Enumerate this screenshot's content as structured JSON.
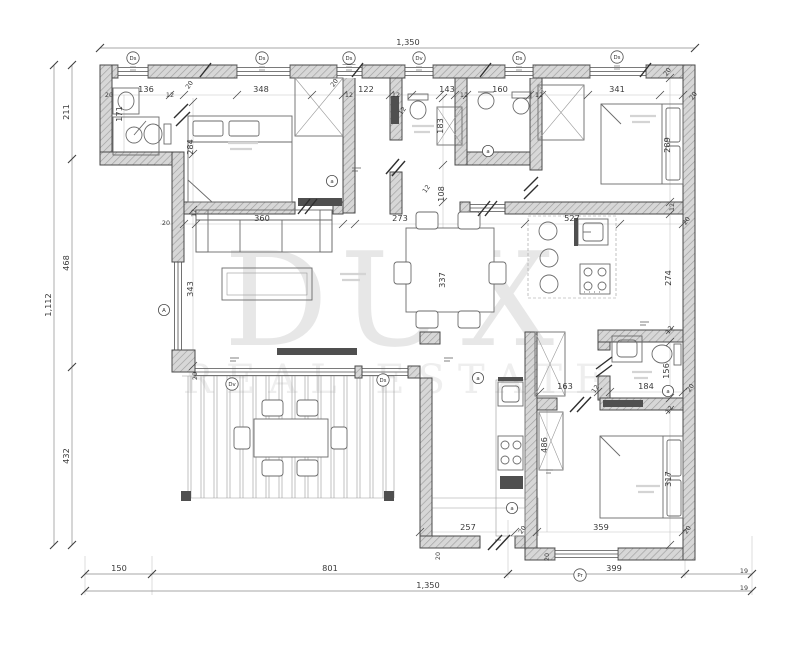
{
  "watermark": {
    "line1": "DUX",
    "line2": "REAL ESTATE"
  },
  "colors": {
    "background": "#ffffff",
    "line": "#4a4a4a",
    "wall_fill": "#d7d7d7",
    "hatch": "#9e9e9e",
    "dim_text": "#3a3a3a",
    "watermark": "#e7e7e7",
    "watermark_light": "#eeeeee",
    "furniture": "#6b6b6b"
  },
  "dimension_labels": [
    {
      "v": "1,350",
      "x": 408,
      "y": 45
    },
    {
      "v": "211",
      "x": 69,
      "y": 112,
      "r": -90
    },
    {
      "v": "468",
      "x": 69,
      "y": 263,
      "r": -90
    },
    {
      "v": "432",
      "x": 69,
      "y": 456,
      "r": -90
    },
    {
      "v": "1,112",
      "x": 51,
      "y": 305,
      "r": -90
    },
    {
      "v": "150",
      "x": 119,
      "y": 571
    },
    {
      "v": "801",
      "x": 330,
      "y": 571
    },
    {
      "v": "399",
      "x": 614,
      "y": 571
    },
    {
      "v": "19",
      "x": 744,
      "y": 573,
      "s": 1
    },
    {
      "v": "1,350",
      "x": 428,
      "y": 588
    },
    {
      "v": "19",
      "x": 744,
      "y": 590,
      "s": 1
    },
    {
      "v": "20",
      "x": 109,
      "y": 97,
      "s": 1
    },
    {
      "v": "136",
      "x": 146,
      "y": 92
    },
    {
      "v": "12",
      "x": 170,
      "y": 97,
      "s": 1
    },
    {
      "v": "20",
      "x": 191,
      "y": 86,
      "r": -55,
      "s": 1
    },
    {
      "v": "348",
      "x": 261,
      "y": 92
    },
    {
      "v": "20",
      "x": 336,
      "y": 84,
      "r": -55,
      "s": 1
    },
    {
      "v": "12",
      "x": 349,
      "y": 97,
      "s": 1
    },
    {
      "v": "122",
      "x": 366,
      "y": 92
    },
    {
      "v": "12",
      "x": 396,
      "y": 97,
      "s": 1
    },
    {
      "v": "143",
      "x": 447,
      "y": 92
    },
    {
      "v": "12",
      "x": 464,
      "y": 97,
      "s": 1
    },
    {
      "v": "160",
      "x": 500,
      "y": 92
    },
    {
      "v": "12",
      "x": 539,
      "y": 97,
      "s": 1
    },
    {
      "v": "341",
      "x": 617,
      "y": 92
    },
    {
      "v": "20",
      "x": 669,
      "y": 73,
      "r": -55,
      "s": 1
    },
    {
      "v": "20",
      "x": 695,
      "y": 97,
      "r": -55,
      "s": 1
    },
    {
      "v": "171",
      "x": 122,
      "y": 114,
      "r": -90
    },
    {
      "v": "284",
      "x": 193,
      "y": 147,
      "r": -90
    },
    {
      "v": "12",
      "x": 404,
      "y": 112,
      "r": -55,
      "s": 1
    },
    {
      "v": "183",
      "x": 443,
      "y": 126,
      "r": -90
    },
    {
      "v": "289",
      "x": 670,
      "y": 145,
      "r": -90
    },
    {
      "v": "12",
      "x": 674,
      "y": 207,
      "r": -90,
      "s": 1
    },
    {
      "v": "108",
      "x": 444,
      "y": 194,
      "r": -90
    },
    {
      "v": "12",
      "x": 428,
      "y": 190,
      "r": -55,
      "s": 1
    },
    {
      "v": "20",
      "x": 166,
      "y": 225,
      "s": 1
    },
    {
      "v": "12",
      "x": 196,
      "y": 213,
      "r": -90,
      "s": 1
    },
    {
      "v": "360",
      "x": 262,
      "y": 221
    },
    {
      "v": "273",
      "x": 400,
      "y": 221
    },
    {
      "v": "527",
      "x": 572,
      "y": 221
    },
    {
      "v": "20",
      "x": 688,
      "y": 222,
      "r": -55,
      "s": 1
    },
    {
      "v": "343",
      "x": 193,
      "y": 289,
      "r": -90
    },
    {
      "v": "337",
      "x": 445,
      "y": 280,
      "r": -90
    },
    {
      "v": "274",
      "x": 671,
      "y": 278,
      "r": -90
    },
    {
      "v": "20",
      "x": 197,
      "y": 376,
      "r": -90,
      "s": 1
    },
    {
      "v": "12",
      "x": 671,
      "y": 331,
      "r": -55,
      "s": 1
    },
    {
      "v": "156",
      "x": 669,
      "y": 371,
      "r": -90
    },
    {
      "v": "163",
      "x": 565,
      "y": 389
    },
    {
      "v": "12",
      "x": 597,
      "y": 390,
      "r": -55,
      "s": 1
    },
    {
      "v": "184",
      "x": 646,
      "y": 389
    },
    {
      "v": "20",
      "x": 692,
      "y": 389,
      "r": -55,
      "s": 1
    },
    {
      "v": "12",
      "x": 671,
      "y": 411,
      "r": -55,
      "s": 1
    },
    {
      "v": "486",
      "x": 547,
      "y": 445,
      "r": -90
    },
    {
      "v": "317",
      "x": 671,
      "y": 479,
      "r": -90
    },
    {
      "v": "257",
      "x": 468,
      "y": 530
    },
    {
      "v": "20",
      "x": 524,
      "y": 531,
      "r": -55,
      "s": 1
    },
    {
      "v": "359",
      "x": 601,
      "y": 530
    },
    {
      "v": "20",
      "x": 689,
      "y": 531,
      "r": -55,
      "s": 1
    },
    {
      "v": "20",
      "x": 440,
      "y": 556,
      "r": -90,
      "s": 1
    },
    {
      "v": "20",
      "x": 549,
      "y": 557,
      "r": -90,
      "s": 1
    }
  ],
  "opening_markers": [
    {
      "l": "Ds",
      "x": 133,
      "y": 58
    },
    {
      "l": "Ds",
      "x": 262,
      "y": 58
    },
    {
      "l": "Ds",
      "x": 349,
      "y": 58
    },
    {
      "l": "Dv",
      "x": 419,
      "y": 58
    },
    {
      "l": "Ds",
      "x": 519,
      "y": 58
    },
    {
      "l": "Ds",
      "x": 617,
      "y": 57
    },
    {
      "l": "a",
      "x": 332,
      "y": 181
    },
    {
      "l": "a",
      "x": 488,
      "y": 151
    },
    {
      "l": "A",
      "x": 164,
      "y": 310
    },
    {
      "l": "Dv",
      "x": 232,
      "y": 384
    },
    {
      "l": "Ds",
      "x": 383,
      "y": 380
    },
    {
      "l": "a",
      "x": 478,
      "y": 378
    },
    {
      "l": "a",
      "x": 512,
      "y": 508
    },
    {
      "l": "a",
      "x": 668,
      "y": 391
    },
    {
      "l": "Pr",
      "x": 580,
      "y": 575
    }
  ]
}
